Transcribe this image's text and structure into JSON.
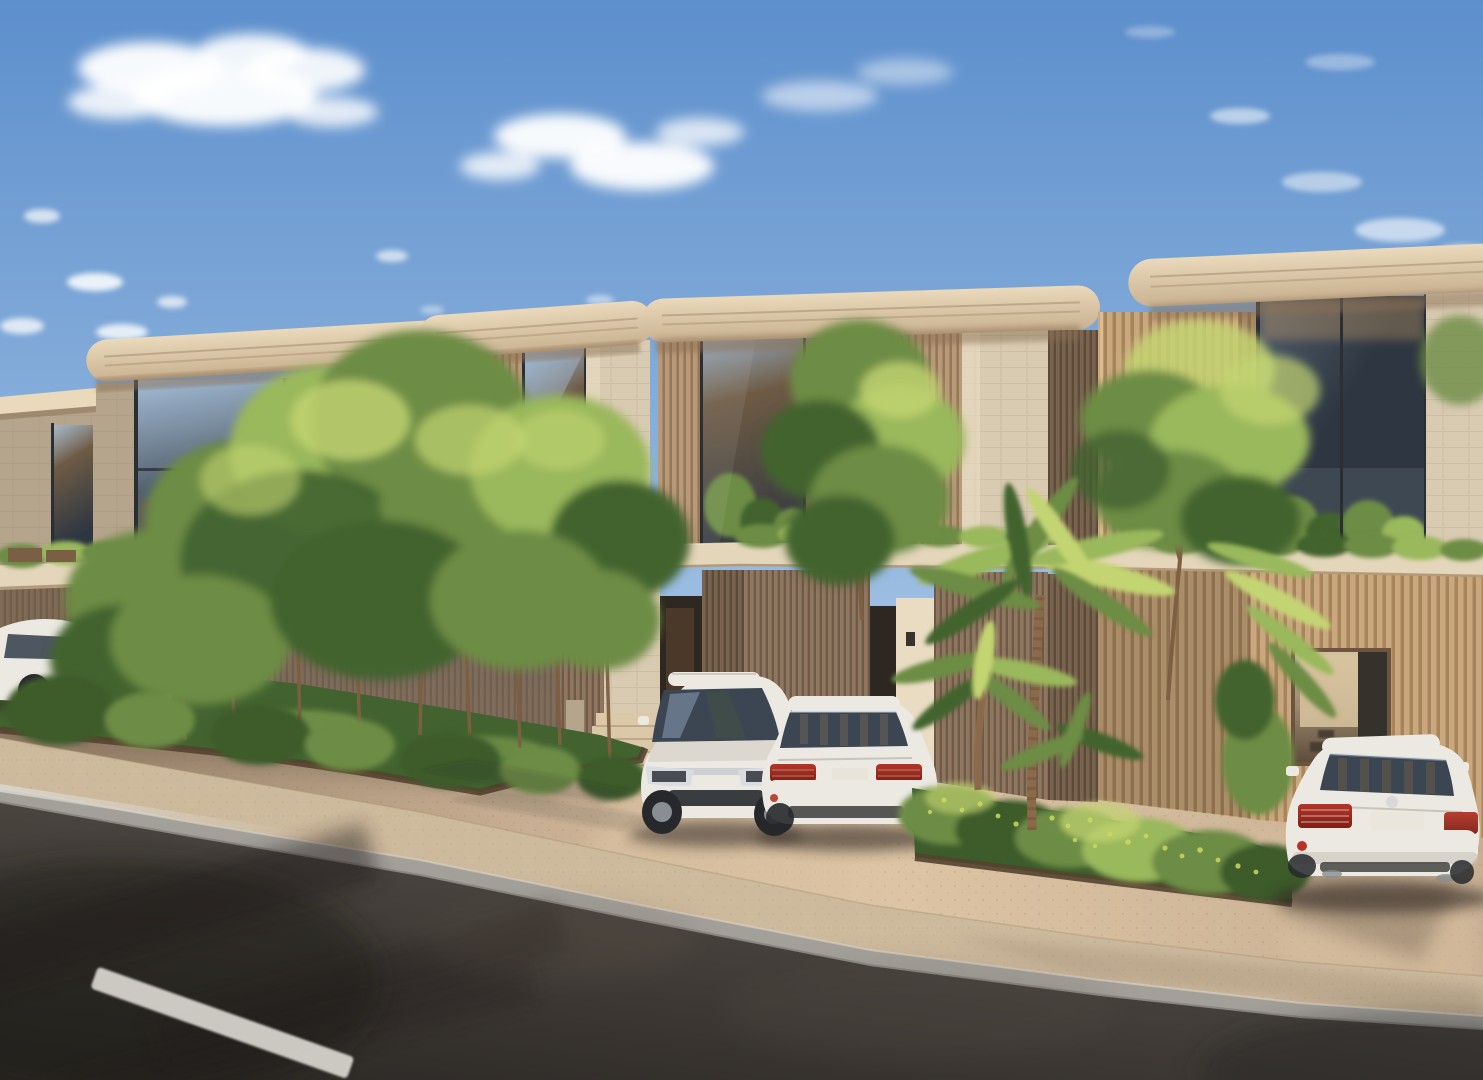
{
  "scene": {
    "description": "Photorealistic architectural rendering of a row of modern two-storey townhouses with curved cream roof slabs and timber-slat facades, front gardens, palm trees and white cars parked on a driveway beside an asphalt street at golden hour",
    "time_of_day": "late afternoon golden hour",
    "weather": "clear blue sky with scattered white clouds"
  },
  "objects": {
    "sky": "blue sky with scattered white clouds",
    "buildings": [
      "townhouse far left (partial)",
      "townhouse left with reflective glass bays",
      "townhouse centre-left with entrance steps",
      "townhouse centre-right with terrace planting",
      "townhouse right with timber screen and garage"
    ],
    "cars": [
      "white car parked far left (partial)",
      "white car behind garden trees",
      "white estate car facing the street",
      "white sedan parked centre, rear view",
      "white sedan parked right, rear view"
    ],
    "vegetation": [
      "front garden with shrubs and slender trees",
      "flowering hedge bed with palm trees",
      "tall feathery tree by the right townhouse",
      "planter greenery along the floor slab"
    ],
    "ground": [
      "beige concrete driveway",
      "stone sidewalk with grey kerb",
      "asphalt street with white dashed lane marking and tree shadows"
    ]
  },
  "palette": {
    "sky_top": "#5d8fcc",
    "sky_mid": "#93b7df",
    "sky_low": "#c6daed",
    "sky_horizon": "#dfeaf4",
    "cloud": "#ffffff",
    "roof_cream": "#ead9bb",
    "roof_shadow": "#c8b190",
    "roof_groove": "#a78d6d",
    "soffit": "#8a6f52",
    "stone_lit": "#d9cbb2",
    "stone_bright": "#e9dcc2",
    "stone_shade": "#b6a58d",
    "stone_line": "#8a7a62",
    "slat_lit": "#caa87e",
    "slat_lit_dark": "#a8845c",
    "slat_mid": "#b99a78",
    "slat_mid_dark": "#95775a",
    "slat_shade": "#8e7660",
    "slat_shade_dark": "#6e5a46",
    "slat_deep": "#7a6450",
    "slat_deep_dark": "#5d4b3a",
    "glass_dark": "#2e3741",
    "glass_mid": "#55616f",
    "glass_sky": "#a3bcd6",
    "glass_warm": "#6e5b45",
    "frame_dark": "#2b2f34",
    "interior_warm": "#9b7b5c",
    "interior_glow": "#c89a66",
    "interior_back": "#d8c49f",
    "slab_cream": "#e4d6ba",
    "slab_edge": "#b49a79",
    "drive_base": "#c7ae92",
    "drive_lit": "#dcc4a4",
    "drive_shade": "#937c67",
    "walk_pale": "#dbc8a8",
    "sidewalk": "#cdb99c",
    "curb_gray": "#a3a09a",
    "curb_face": "#83807a",
    "road_light": "#5a544d",
    "road_mid": "#443f3a",
    "road_dark": "#2c2825",
    "lane_white": "#dad7d0",
    "green_dark": "#42632f",
    "green_mid": "#6d8c45",
    "green_light": "#9ab85c",
    "green_lit": "#c3d472",
    "hedge_dark": "#3c5c2c",
    "flower_yellow": "#cdd95e",
    "bed_edge": "#54422f",
    "trunk": "#7d5f41",
    "palm_trunk": "#8a6a4a",
    "palm_ring": "#6e5138",
    "car_white": "#ece9e2",
    "car_shade": "#c9c4ba",
    "car_glass": "#3c4653",
    "glass_reflect": "#8fa3bd",
    "taillight": "#b53427",
    "taillight_dark": "#7e1f16",
    "chrome": "#c9cdd2",
    "tire": "#26282b",
    "wheel_face": "#9aa0a6",
    "shadow_warm": "#2f2823"
  }
}
